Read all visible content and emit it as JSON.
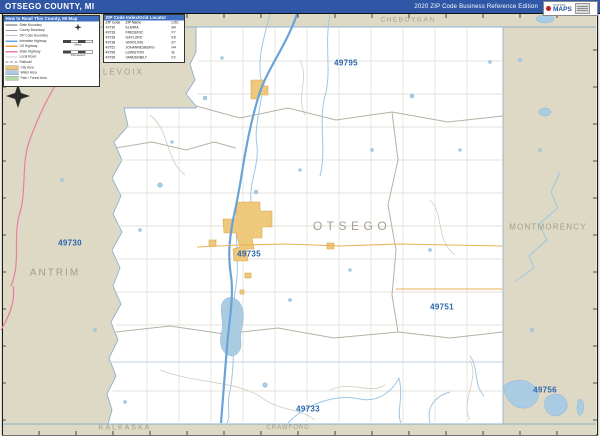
{
  "header": {
    "title": "OTSEGO COUNTY, MI",
    "edition": "2020 ZIP Code Business Reference Edition",
    "logo": {
      "market": "market",
      "maps": "MAPS"
    }
  },
  "legend": {
    "title": "How to Read This County, MI Map",
    "items": [
      {
        "label": "State Boundary",
        "swatch": "line-dark"
      },
      {
        "label": "County Boundary",
        "swatch": "line-mid"
      },
      {
        "label": "ZIP Code Boundary",
        "swatch": "line-light"
      },
      {
        "label": "Interstate Highway",
        "swatch": "line-blue"
      },
      {
        "label": "US Highway",
        "swatch": "line-orange"
      },
      {
        "label": "State Highway",
        "swatch": "line-pink"
      },
      {
        "label": "Local Road",
        "swatch": "line-gray"
      },
      {
        "label": "Railroad",
        "swatch": "line-dash"
      },
      {
        "label": "City Area",
        "swatch": "fill-orange"
      },
      {
        "label": "Water Area",
        "swatch": "fill-blue"
      },
      {
        "label": "Park / Forest Area",
        "swatch": "fill-green"
      }
    ],
    "scale": {
      "miles": "Miles",
      "km": "Kilometers"
    }
  },
  "zip_index": {
    "title": "ZIP Code Index/Grid Locator",
    "columns": [
      "ZIP Code",
      "ZIP Name",
      "LOC"
    ],
    "rows": [
      {
        "zip": "49730",
        "name": "ELMIRA",
        "loc": "B4"
      },
      {
        "zip": "49733",
        "name": "FREDERIC",
        "loc": "F7"
      },
      {
        "zip": "49735",
        "name": "GAYLORD",
        "loc": "E5"
      },
      {
        "zip": "49738",
        "name": "GRAYLING",
        "loc": "E7"
      },
      {
        "zip": "49751",
        "name": "JOHANNESBURG",
        "loc": "H4"
      },
      {
        "zip": "49756",
        "name": "LEWISTON",
        "loc": "I6"
      },
      {
        "zip": "49795",
        "name": "VANDERBILT",
        "loc": "F2"
      }
    ]
  },
  "map": {
    "county_labels": {
      "cheboygan": "CHEBOYGAN",
      "charlevoix": "CHARLEVOIX",
      "montmorency": "MONTMORENCY",
      "antrim": "ANTRIM",
      "otsego": "OTSEGO",
      "kalkaska": "KALKASKA",
      "crawford": "CRAWFORD"
    },
    "zip_labels": {
      "z49795": "49795",
      "z49730": "49730",
      "z49735": "49735",
      "z49751": "49751",
      "z49733": "49733",
      "z49756": "49756"
    },
    "colors": {
      "header_blue": "#2f57a5",
      "panel_title_blue": "#3e6fbe",
      "outside_area_tan": "#ded9c5",
      "water_blue": "#a9cce3",
      "city_orange": "#eec87b",
      "interstate_blue": "#6aa3d8",
      "us_highway_orange": "#e8a33d",
      "state_highway_pink": "#e77fa0",
      "zip_label_blue": "#2a67ad",
      "county_label_gray": "#a39d8c"
    }
  }
}
